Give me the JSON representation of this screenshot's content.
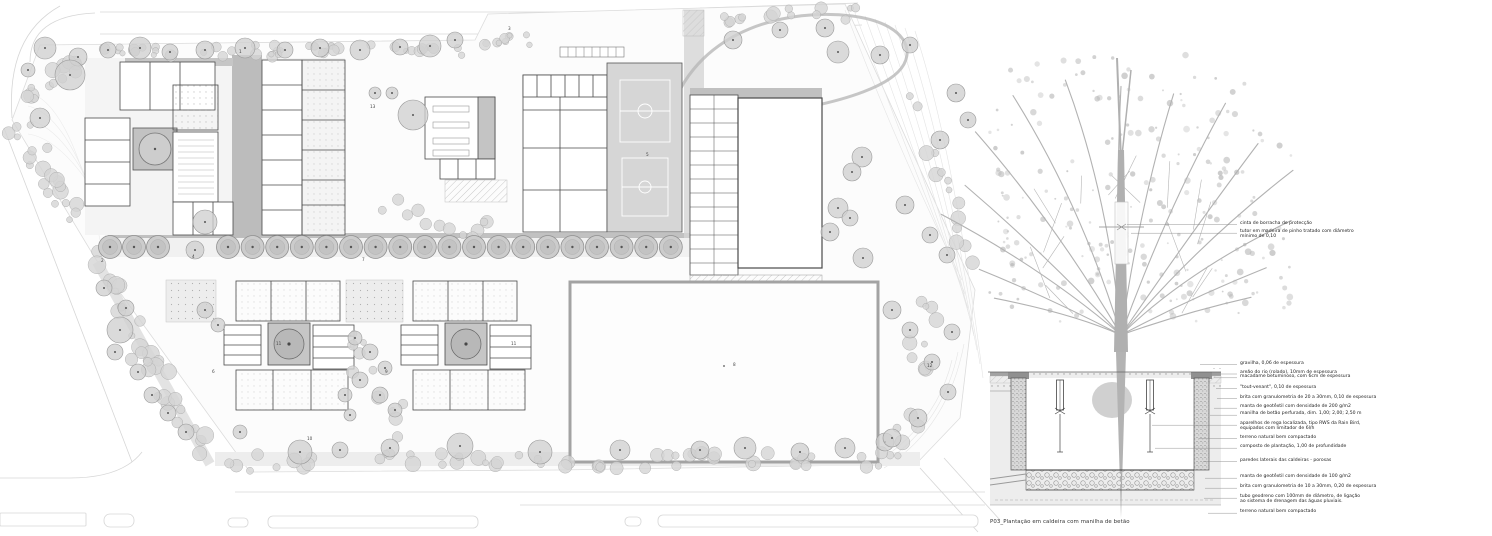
{
  "drawing": {
    "caption": "P03_Plantação em caldeira com manilha de betão",
    "plan_numbers": [
      "1",
      "2",
      "3",
      "4",
      "5",
      "6",
      "7",
      "8",
      "9",
      "10",
      "11",
      "11",
      "12",
      "13"
    ],
    "tree_labels": [
      "cinta de borracha de protecção",
      "tutor em madeira de pinho tratado com diâmetro\nmínimo de 0,10"
    ],
    "section_labels": [
      "gravilha, 0,06 de espessura",
      "areão do rio (rolado), 10mm de espessura",
      "macadame betuminoso, com 6cm de espessura",
      "\"tout-venant\", 0,10 de espessura",
      "brita com granulometria de 20 a 30mm, 0,10 de espessura",
      "manta de geotêxtil com densidade de 200 g/m2",
      "manilha de betão perfurada, dim. 1,00; 2,00; 2,50 m",
      "aparelhos de rega localizada, tipo RWS da Rain Bird,\nequipados com limitador de 6l/h",
      "terreno natural bem compactado",
      "composto de plantação, 1,00 de profundidade",
      "paredes laterais das caldeiras - porosas",
      "manta de geotêxtil com densidade de 100 g/m2",
      "brita com granulometria de 10 a 30mm, 0,20 de espessura",
      "tubo geodreno com 100mm de diâmetro, de ligação\nao sistema de drenagem das águas pluviais.",
      "terreno natural bem compactado"
    ],
    "colors": {
      "wall_dark": "#3a3a3a",
      "roof_gray": "#bcbcbc",
      "court_gray": "#d6d6d6",
      "vegetation_gray": "#d4d4d4",
      "canopy_gray": "#b7b7b7",
      "paper": "#ffffff"
    }
  }
}
